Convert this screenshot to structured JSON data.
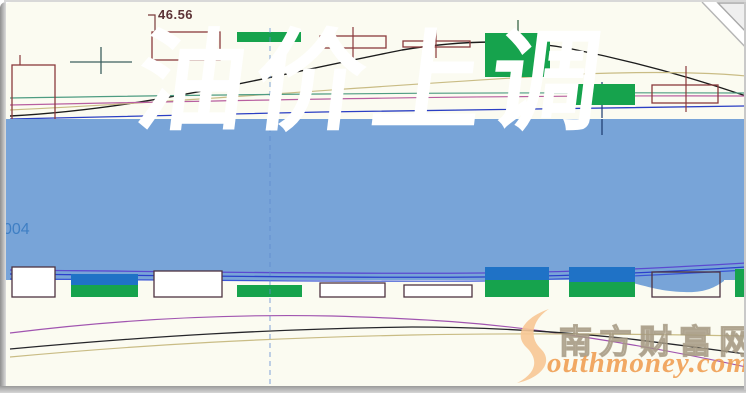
{
  "banner": {
    "title": "油价上调",
    "bg_color": "#78a4d8",
    "text_color": "#ffffff"
  },
  "labels": {
    "price": "46.56",
    "left_axis": "004"
  },
  "watermark": {
    "logo_letter": "S",
    "cn_text": "南方财富网",
    "en_text": "outhmoney.com",
    "orange": "#ee994a",
    "logo_fill": "#f7c795"
  },
  "chart_data": {
    "type": "candlestick",
    "title": "油价上调",
    "note": "stock candlestick chart, no axis scales visible; coordinates are pixel-space; only labeled price is 46.56",
    "price_label": {
      "text": "46.56",
      "x": 156,
      "y": 5
    },
    "colors": {
      "green": "#16a34d",
      "blue": "#1f72c6",
      "hollow_border": "#8a3a3c",
      "strip_border": "#4d3340",
      "banner": "#78a4d8",
      "dashed": "#5f8cd0"
    },
    "dashed_line": {
      "x": 268,
      "y0": 26,
      "y1": 388
    },
    "banner_bulge": "M612,278 C640,281 650,289 682,290 C702,291 712,286 722,279 L722,274 L612,274 Z",
    "top_candles": [
      {
        "x": 10,
        "w": 43,
        "y0": 63,
        "y1": 128,
        "kind": "outline",
        "wick": {
          "x": 18,
          "t": 53,
          "b": 63
        }
      },
      {
        "x": 150,
        "w": 68,
        "y0": 30,
        "y1": 58,
        "kind": "outline",
        "wick": {
          "x": 184,
          "t": 58,
          "b": 68
        }
      },
      {
        "x": 235,
        "w": 64,
        "y0": 30,
        "y1": 40,
        "kind": "green"
      },
      {
        "x": 318,
        "w": 66,
        "y0": 34,
        "y1": 46,
        "kind": "outline",
        "wick": {
          "x": 351,
          "t": 25,
          "b": 56
        }
      },
      {
        "x": 401,
        "w": 67,
        "y0": 39,
        "y1": 45,
        "kind": "outline",
        "wick": {
          "x": 434,
          "t": 28,
          "b": 56
        }
      },
      {
        "x": 483,
        "w": 65,
        "y0": 31,
        "y1": 75,
        "kind": "green",
        "wick": {
          "x": 516,
          "t": 18,
          "b": 90
        },
        "wickColor": "#2a5a3a"
      },
      {
        "x": 567,
        "w": 66,
        "y0": 82,
        "y1": 103,
        "kind": "green",
        "wick": {
          "x": 600,
          "t": 80,
          "b": 116
        },
        "wickColor": "#1c3a6e"
      },
      {
        "x": 650,
        "w": 66,
        "y0": 83,
        "y1": 101,
        "kind": "outline",
        "wick": {
          "x": 684,
          "t": 64,
          "b": 110
        }
      }
    ],
    "strip_candles": [
      {
        "x": 10,
        "w": 43,
        "y0": 265,
        "y1": 295,
        "kind": "hollow"
      },
      {
        "x": 69,
        "w": 67,
        "y0": 272,
        "y1": 295,
        "kind": "bluegreen",
        "split": 283
      },
      {
        "x": 152,
        "w": 68,
        "y0": 269,
        "y1": 295,
        "kind": "hollow"
      },
      {
        "x": 235,
        "w": 65,
        "y0": 283,
        "y1": 295,
        "kind": "green"
      },
      {
        "x": 318,
        "w": 65,
        "y0": 281,
        "y1": 295,
        "kind": "hollow"
      },
      {
        "x": 402,
        "w": 68,
        "y0": 283,
        "y1": 295,
        "kind": "hollow"
      },
      {
        "x": 483,
        "w": 64,
        "y0": 265,
        "y1": 295,
        "kind": "bluegreen",
        "split": 278
      },
      {
        "x": 567,
        "w": 66,
        "y0": 265,
        "y1": 295,
        "kind": "bluegreen",
        "split": 280
      },
      {
        "x": 650,
        "w": 68,
        "y0": 270,
        "y1": 295,
        "kind": "outline"
      },
      {
        "x": 733,
        "w": 11,
        "y0": 267,
        "y1": 295,
        "kind": "green"
      }
    ],
    "lines": {
      "top": [
        {
          "c": "#1c1c1c",
          "w": 1.4,
          "d": "M8,114 C140,107 250,78 400,48 C460,38 520,37 570,47 C640,61 700,79 744,94"
        },
        {
          "c": "#c9bc85",
          "w": 1.2,
          "d": "M8,108 C200,99 420,80 580,72 C660,69 715,71 744,74"
        },
        {
          "c": "#4e9c82",
          "w": 1.2,
          "d": "M8,96 C200,93 400,90 744,91"
        },
        {
          "c": "#b85fa0",
          "w": 1.2,
          "d": "M8,103 C250,98 500,93 744,94"
        },
        {
          "c": "#2b3fc4",
          "w": 1.3,
          "d": "M8,117 C120,114 220,112 320,110 C460,108 600,106 744,104"
        },
        {
          "c": "#3d6060",
          "w": 1.3,
          "d": "M68,60 L130,60"
        },
        {
          "c": "#3d6060",
          "w": 1.3,
          "d": "M99,45 L99,72"
        },
        {
          "c": "#7a3b3b",
          "w": 1.2,
          "d": "M146,13 L153,13 L153,30"
        }
      ],
      "strip": [
        {
          "c": "#5b4ad0",
          "w": 1.3,
          "d": "M8,268 C200,270 360,272 480,271 C580,270 660,266 744,261"
        },
        {
          "c": "#2b40cc",
          "w": 1.3,
          "d": "M8,272 C200,274 360,276 480,275 C580,274 660,270 744,265"
        },
        {
          "c": "#3a55d6",
          "w": 1.2,
          "d": "M8,277 C200,278 360,280 480,279 C580,277 660,273 744,268"
        },
        {
          "c": "#1c3a6e",
          "w": 1.2,
          "d": "M600,117 L600,133"
        }
      ],
      "bottom": [
        {
          "c": "#a155b0",
          "w": 1.2,
          "d": "M8,331 C120,317 230,312 330,314 C430,317 480,321 540,329 C620,340 690,353 744,365"
        },
        {
          "c": "#26262a",
          "w": 1.3,
          "d": "M8,347 C150,334 270,327 410,325 C490,325 560,330 620,336 C670,342 715,348 744,352"
        },
        {
          "c": "#c9bc85",
          "w": 1.2,
          "d": "M8,355 C150,342 270,336 410,333 C520,331 640,332 744,334"
        }
      ]
    }
  }
}
